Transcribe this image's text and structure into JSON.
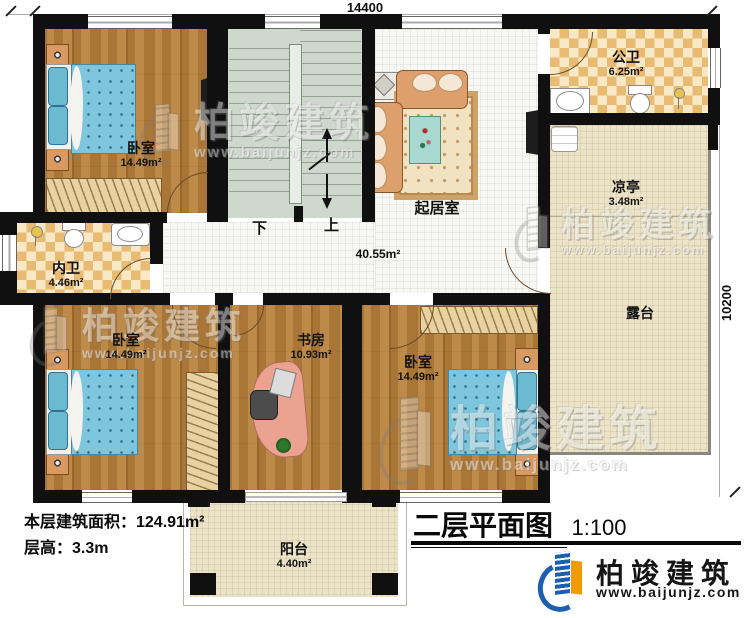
{
  "dimensions": {
    "top": "14400",
    "right": "10200"
  },
  "rooms": {
    "bedroom_tl": {
      "name": "卧室",
      "area": "14.49m²"
    },
    "bedroom_bl": {
      "name": "卧室",
      "area": "14.49m²"
    },
    "bedroom_br": {
      "name": "卧室",
      "area": "14.49m²"
    },
    "study": {
      "name": "书房",
      "area": "10.93m²"
    },
    "living": {
      "name": "起居室",
      "area": "40.55m²"
    },
    "public_bath": {
      "name": "公卫",
      "area": "6.25m²"
    },
    "inner_bath": {
      "name": "内卫",
      "area": "4.46m²"
    },
    "pavilion": {
      "name": "凉亭",
      "area": "3.48m²"
    },
    "terrace": {
      "name": "露台"
    },
    "balcony": {
      "name": "阳台",
      "area": "4.40m²"
    }
  },
  "stairs": {
    "down_label": "下",
    "up_label": "上"
  },
  "info": {
    "floor_area": "本层建筑面积：124.91m²",
    "floor_height": "层高：3.3m"
  },
  "title": {
    "text": "二层平面图",
    "scale": "1:100"
  },
  "brand": {
    "name": "柏竣建筑",
    "website": "www.baijunjz.com"
  },
  "colors": {
    "wall": "#101010",
    "brand_blue": "#1c5fae",
    "brand_orange": "#f29b00",
    "wood": "#b27e3c",
    "tile": "#f7f7f4",
    "beige": "#ece4c9",
    "checker": "#e9bb72",
    "stair": "#cfd8cd",
    "bed_blue": "#7ec6dd"
  }
}
